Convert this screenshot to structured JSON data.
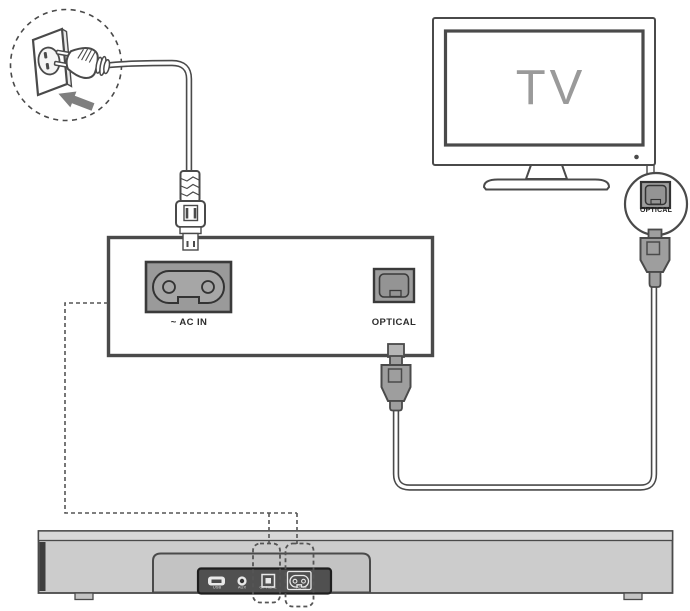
{
  "tv": {
    "screen_label": "TV",
    "optical_port_label": "OPTICAL"
  },
  "rear_panel_zoom": {
    "ac_in_label": "~ AC IN",
    "optical_label": "OPTICAL"
  },
  "soundbar": {
    "port_labels": {
      "usb": "USB",
      "aux": "AUX",
      "optical": "OPTICAL",
      "ac_in": "~AC IN"
    }
  },
  "colors": {
    "line": "#4a4a4a",
    "connector_gray": "#9e9e9e",
    "soundbar_gray": "#cccccc",
    "port_panel_dark": "#505050",
    "tv_text_gray": "#9a9a9a",
    "arrow_gray": "#7f7f7f"
  }
}
